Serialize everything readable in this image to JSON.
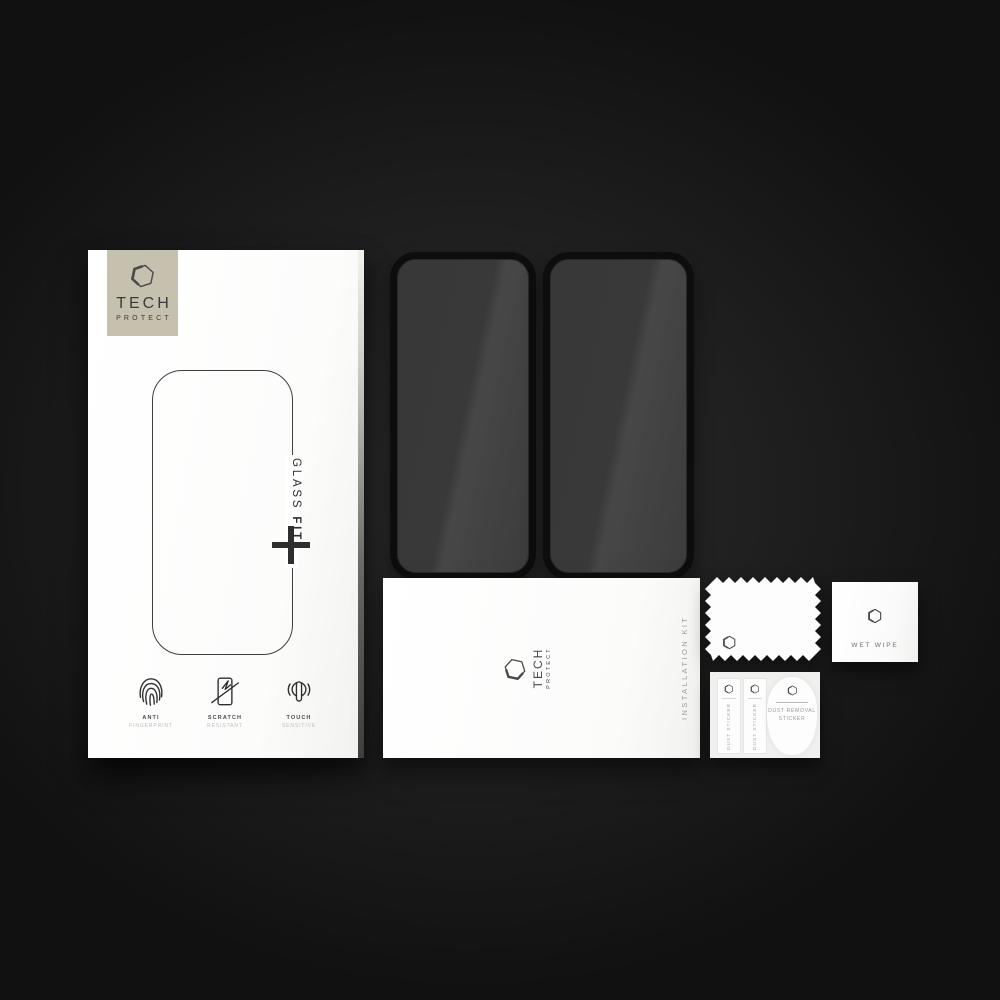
{
  "scene": {
    "description": "Product photo of a Tech-Protect Glass Fit tempered glass screen protector set on a dark background"
  },
  "brand": {
    "name_line1": "TECH",
    "name_line2": "PROTECT"
  },
  "retail_box": {
    "product_name_word1": "GLASS",
    "product_name_word2": "FIT",
    "plus_symbol": "+",
    "features": [
      {
        "title": "ANTI",
        "subtitle": "FINGERPRINT",
        "icon": "fingerprint-icon"
      },
      {
        "title": "SCRATCH",
        "subtitle": "RESISTANT",
        "icon": "scratch-screen-icon"
      },
      {
        "title": "TOUCH",
        "subtitle": "SENSITIVE",
        "icon": "touch-point-icon"
      }
    ]
  },
  "glass_protectors": {
    "count": 2
  },
  "installation_kit": {
    "label": "INSTALLATION KIT"
  },
  "wet_wipe": {
    "label": "WET WIPE"
  },
  "dust_stickers": {
    "strip_label": "DUST STICKER",
    "main_label_line1": "DUST REMOVAL",
    "main_label_line2": "STICKER"
  },
  "icons": {
    "brand_logo": "hexagon-logo-icon"
  },
  "colors": {
    "background": "#1f1f1f",
    "box_white": "#fcfcfb",
    "logo_square_beige": "#c6c0ae",
    "glass_fill": "#3d3d3d",
    "glass_border": "#0d0d0d",
    "text_dark": "#2f2f2f",
    "text_gray": "#9a9a9a"
  }
}
